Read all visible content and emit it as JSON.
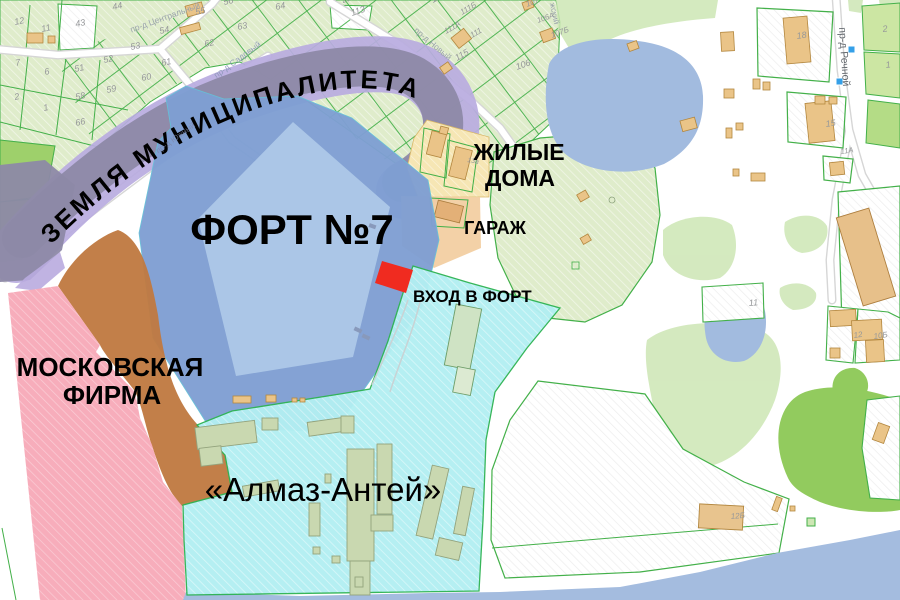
{
  "map": {
    "title": "Cadastral map of Fort No.7 area with ownership annotations",
    "regions": [
      {
        "id": "municipal-land",
        "label": "ЗЕМЛЯ МУНИЦИПАЛИТЕТА",
        "color": "#b9abdf"
      },
      {
        "id": "fort",
        "label": "ФОРТ №7",
        "color": "#7f9fd3"
      },
      {
        "id": "fort-entrance",
        "label": "ВХОД В ФОРТ",
        "color": "#f02b20"
      },
      {
        "id": "residential",
        "label": "ЖИЛЫЕ ДОМА",
        "color": "#f6e6b4"
      },
      {
        "id": "garage",
        "label": "ГАРАЖ",
        "color": "#f2cfa2"
      },
      {
        "id": "moscow-firm",
        "label": "МОСКОВСКАЯ ФИРМА",
        "color": "#f7aab9"
      },
      {
        "id": "almaz-antey",
        "label": "«Алмаз-Антей»",
        "color": "#b2eff2"
      },
      {
        "id": "unlabeled-brown",
        "label": "",
        "color": "#bf7a42"
      }
    ],
    "curved_annotation": {
      "text": "ЗЕМЛЯ МУНИЦИПАЛИТЕТА"
    },
    "annotations": [
      {
        "id": "fort-label",
        "text": "ФОРТ №7",
        "x": 292,
        "y": 244,
        "size": 42,
        "weight": "bold",
        "anchor": "middle"
      },
      {
        "id": "residential-label-1",
        "text": "ЖИЛЫЕ",
        "x": 519,
        "y": 160,
        "size": 23,
        "weight": "bold",
        "anchor": "middle"
      },
      {
        "id": "residential-label-2",
        "text": "ДОМА",
        "x": 520,
        "y": 186,
        "size": 23,
        "weight": "bold",
        "anchor": "middle"
      },
      {
        "id": "garage-label",
        "text": "ГАРАЖ",
        "x": 495,
        "y": 234,
        "size": 18,
        "weight": "bold",
        "anchor": "middle"
      },
      {
        "id": "entrance-label",
        "text": "ВХОД В ФОРТ",
        "x": 413,
        "y": 302,
        "size": 17,
        "weight": "bold",
        "anchor": "start"
      },
      {
        "id": "moscow-firm-label-1",
        "text": "МОСКОВСКАЯ",
        "x": 110,
        "y": 376,
        "size": 26,
        "weight": "bold",
        "anchor": "middle"
      },
      {
        "id": "moscow-firm-label-2",
        "text": "ФИРМА",
        "x": 112,
        "y": 404,
        "size": 26,
        "weight": "bold",
        "anchor": "middle"
      },
      {
        "id": "almaz-antey-label",
        "text": "«Алмаз-Антей»",
        "x": 323,
        "y": 501,
        "size": 33,
        "weight": "normal",
        "anchor": "middle"
      }
    ],
    "street_labels": [
      {
        "text": "пр-д Центральный",
        "x": 166,
        "y": 20,
        "rot": -20,
        "color": "#9aa3ab",
        "size": 8.5,
        "op": 1
      },
      {
        "text": "пр-д Садовый",
        "x": 239,
        "y": 62,
        "rot": -36,
        "color": "#8a96b6",
        "size": 8.5,
        "op": 0.9
      },
      {
        "text": "пр-д Южный",
        "x": 177,
        "y": 140,
        "rot": -36,
        "color": "#7d85a6",
        "size": 8,
        "op": 0.7
      },
      {
        "text": "пр-д Новый",
        "x": 431,
        "y": 46,
        "rot": 40,
        "color": "#9aa3ab",
        "size": 8.5,
        "op": 1
      },
      {
        "text": "пр-д Речной",
        "x": 841,
        "y": 57,
        "rot": 86,
        "color": "#63686e",
        "size": 10.5,
        "op": 1
      },
      {
        "text": "жский",
        "x": 552,
        "y": 14,
        "rot": 78,
        "color": "#9aa3ab",
        "size": 8,
        "op": 1
      }
    ],
    "parcel_labels": [
      {
        "t": "12",
        "x": 15,
        "y": 25
      },
      {
        "t": "11",
        "x": 42,
        "y": 32
      },
      {
        "t": "43",
        "x": 76,
        "y": 27
      },
      {
        "t": "44",
        "x": 113,
        "y": 10
      },
      {
        "t": "55",
        "x": 196,
        "y": 15
      },
      {
        "t": "56",
        "x": 224,
        "y": 5
      },
      {
        "t": "64",
        "x": 276,
        "y": 10
      },
      {
        "t": "63",
        "x": 238,
        "y": 30
      },
      {
        "t": "54",
        "x": 160,
        "y": 34
      },
      {
        "t": "53",
        "x": 131,
        "y": 50
      },
      {
        "t": "62",
        "x": 205,
        "y": 47
      },
      {
        "t": "61",
        "x": 162,
        "y": 66
      },
      {
        "t": "52",
        "x": 104,
        "y": 63
      },
      {
        "t": "51",
        "x": 75,
        "y": 72
      },
      {
        "t": "60",
        "x": 142,
        "y": 81
      },
      {
        "t": "59",
        "x": 107,
        "y": 93
      },
      {
        "t": "58",
        "x": 76,
        "y": 100
      },
      {
        "t": "66",
        "x": 76,
        "y": 126
      },
      {
        "t": "7",
        "x": 16,
        "y": 66
      },
      {
        "t": "6",
        "x": 45,
        "y": 75
      },
      {
        "t": "2",
        "x": 15,
        "y": 100
      },
      {
        "t": "1",
        "x": 44,
        "y": 111
      },
      {
        "t": "113",
        "x": 352,
        "y": 16,
        "r": -18
      },
      {
        "t": "20Б",
        "x": 343,
        "y": 3,
        "r": -18,
        "s": 7.5
      },
      {
        "t": "112",
        "x": 433,
        "y": 3,
        "r": -30
      },
      {
        "t": "111Б",
        "x": 462,
        "y": 15,
        "r": -30,
        "s": 8
      },
      {
        "t": "111А",
        "x": 446,
        "y": 34,
        "r": -30,
        "s": 8
      },
      {
        "t": "111",
        "x": 472,
        "y": 38,
        "r": -30,
        "s": 8
      },
      {
        "t": "115",
        "x": 457,
        "y": 61,
        "r": -30
      },
      {
        "t": "107",
        "x": 527,
        "y": 7,
        "r": -20,
        "s": 8
      },
      {
        "t": "106А",
        "x": 538,
        "y": 23,
        "r": -20,
        "s": 7.5
      },
      {
        "t": "107Б",
        "x": 552,
        "y": 38,
        "r": -20,
        "s": 8
      },
      {
        "t": "106",
        "x": 517,
        "y": 70,
        "r": -20
      },
      {
        "t": "18",
        "x": 797,
        "y": 39,
        "r": -8
      },
      {
        "t": "15",
        "x": 826,
        "y": 127,
        "r": -8
      },
      {
        "t": "11А",
        "x": 841,
        "y": 154,
        "r": -8,
        "s": 7.5
      },
      {
        "t": "2",
        "x": 883,
        "y": 32,
        "r": -8
      },
      {
        "t": "1",
        "x": 886,
        "y": 68,
        "r": -8
      },
      {
        "t": "11",
        "x": 749,
        "y": 306,
        "r": -5
      },
      {
        "t": "12Б",
        "x": 731,
        "y": 519,
        "r": -5,
        "s": 8
      },
      {
        "t": "12",
        "x": 854,
        "y": 338,
        "r": -8,
        "s": 8
      },
      {
        "t": "10Б",
        "x": 874,
        "y": 339,
        "r": -8,
        "s": 8
      },
      {
        "t": "13а",
        "x": 467,
        "y": 162,
        "r": 10,
        "s": 7
      }
    ],
    "colors": {
      "parcel_green": "#dfeccb",
      "parcel_border": "#43b049",
      "bright_green": "#9ed06b",
      "blob_green": "#c9e3ab",
      "pond_blue": "#a2bbdf",
      "water_blue": "#a4bcdf",
      "fort_moat": "#7f9fd3",
      "fort_inner": "#adc8e8",
      "lavender": "#b9abdf",
      "slate": "#8d89a7",
      "pink": "#f7aab9",
      "brown": "#bf7a42",
      "cyan": "#b2eff2",
      "building_tan": "#eac488",
      "building_olive": "#c9d8b0",
      "marker_red": "#f02b20",
      "road_white": "#ffffff"
    }
  }
}
